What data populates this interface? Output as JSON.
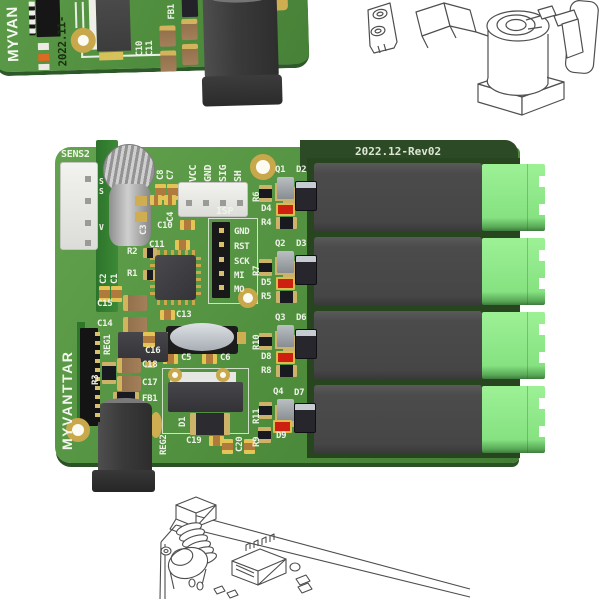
{
  "fragment_board": {
    "brand_partial": "MYVAN",
    "date_code": "2022.11-",
    "labels": {
      "c10": "C10",
      "c11": "C11",
      "fb1": "FB1"
    }
  },
  "main_board": {
    "revision": "2022.12-Rev02",
    "brand": "MYVANTTAR",
    "sens2_label": "SENS2",
    "sens2_pins": {
      "p1": "S",
      "p2": "S",
      "p4": "V"
    },
    "signal_header": {
      "vcc": "VCC",
      "gnd": "GND",
      "sig": "SIG",
      "sh": "SH"
    },
    "isp": {
      "label": "ISP",
      "pin_gnd": "GND",
      "pin_rst": "RST",
      "pin_sck": "SCK",
      "pin_mi": "MI",
      "pin_mo": "MO"
    },
    "silkscreen": {
      "c8": "C8",
      "c7": "C7",
      "c3": "C3",
      "c4": "C4",
      "c10": "C10",
      "c11": "C11",
      "r2": "R2",
      "r1": "R1",
      "c2": "C2",
      "c1": "C1",
      "c15": "C15",
      "c14": "C14",
      "c13": "C13",
      "c16": "C16",
      "c5": "C5",
      "c6": "C6",
      "c18": "C18",
      "c17": "C17",
      "fb1": "FB1",
      "reg1": "REG1",
      "reg2": "REG2",
      "r3": "R3",
      "d1": "D1",
      "c19": "C19",
      "c20": "C20"
    },
    "channels": [
      {
        "transistor": "Q1",
        "flyback_diode": "D2",
        "series_resistor": "R6",
        "led": "D4",
        "led_resistor": "R4"
      },
      {
        "transistor": "Q2",
        "flyback_diode": "D3",
        "series_resistor": "R7",
        "led": "D5",
        "led_resistor": "R5"
      },
      {
        "transistor": "Q3",
        "flyback_diode": "D6",
        "series_resistor": "R10",
        "led": "D8",
        "led_resistor": "R8"
      },
      {
        "transistor": "Q4",
        "flyback_diode": "D7",
        "series_resistor": "R11",
        "led": "D9",
        "led_resistor": "R9"
      }
    ]
  },
  "colors": {
    "pcb_green": "#4f8e3d",
    "pcb_dark_green": "#2c4a26",
    "relay_gray": "#4a4a4a",
    "terminal_green": "#8ee88b",
    "pad_gold": "#c9a84c",
    "silkscreen_white": "#eef3e8",
    "led_red": "#cf2010"
  }
}
